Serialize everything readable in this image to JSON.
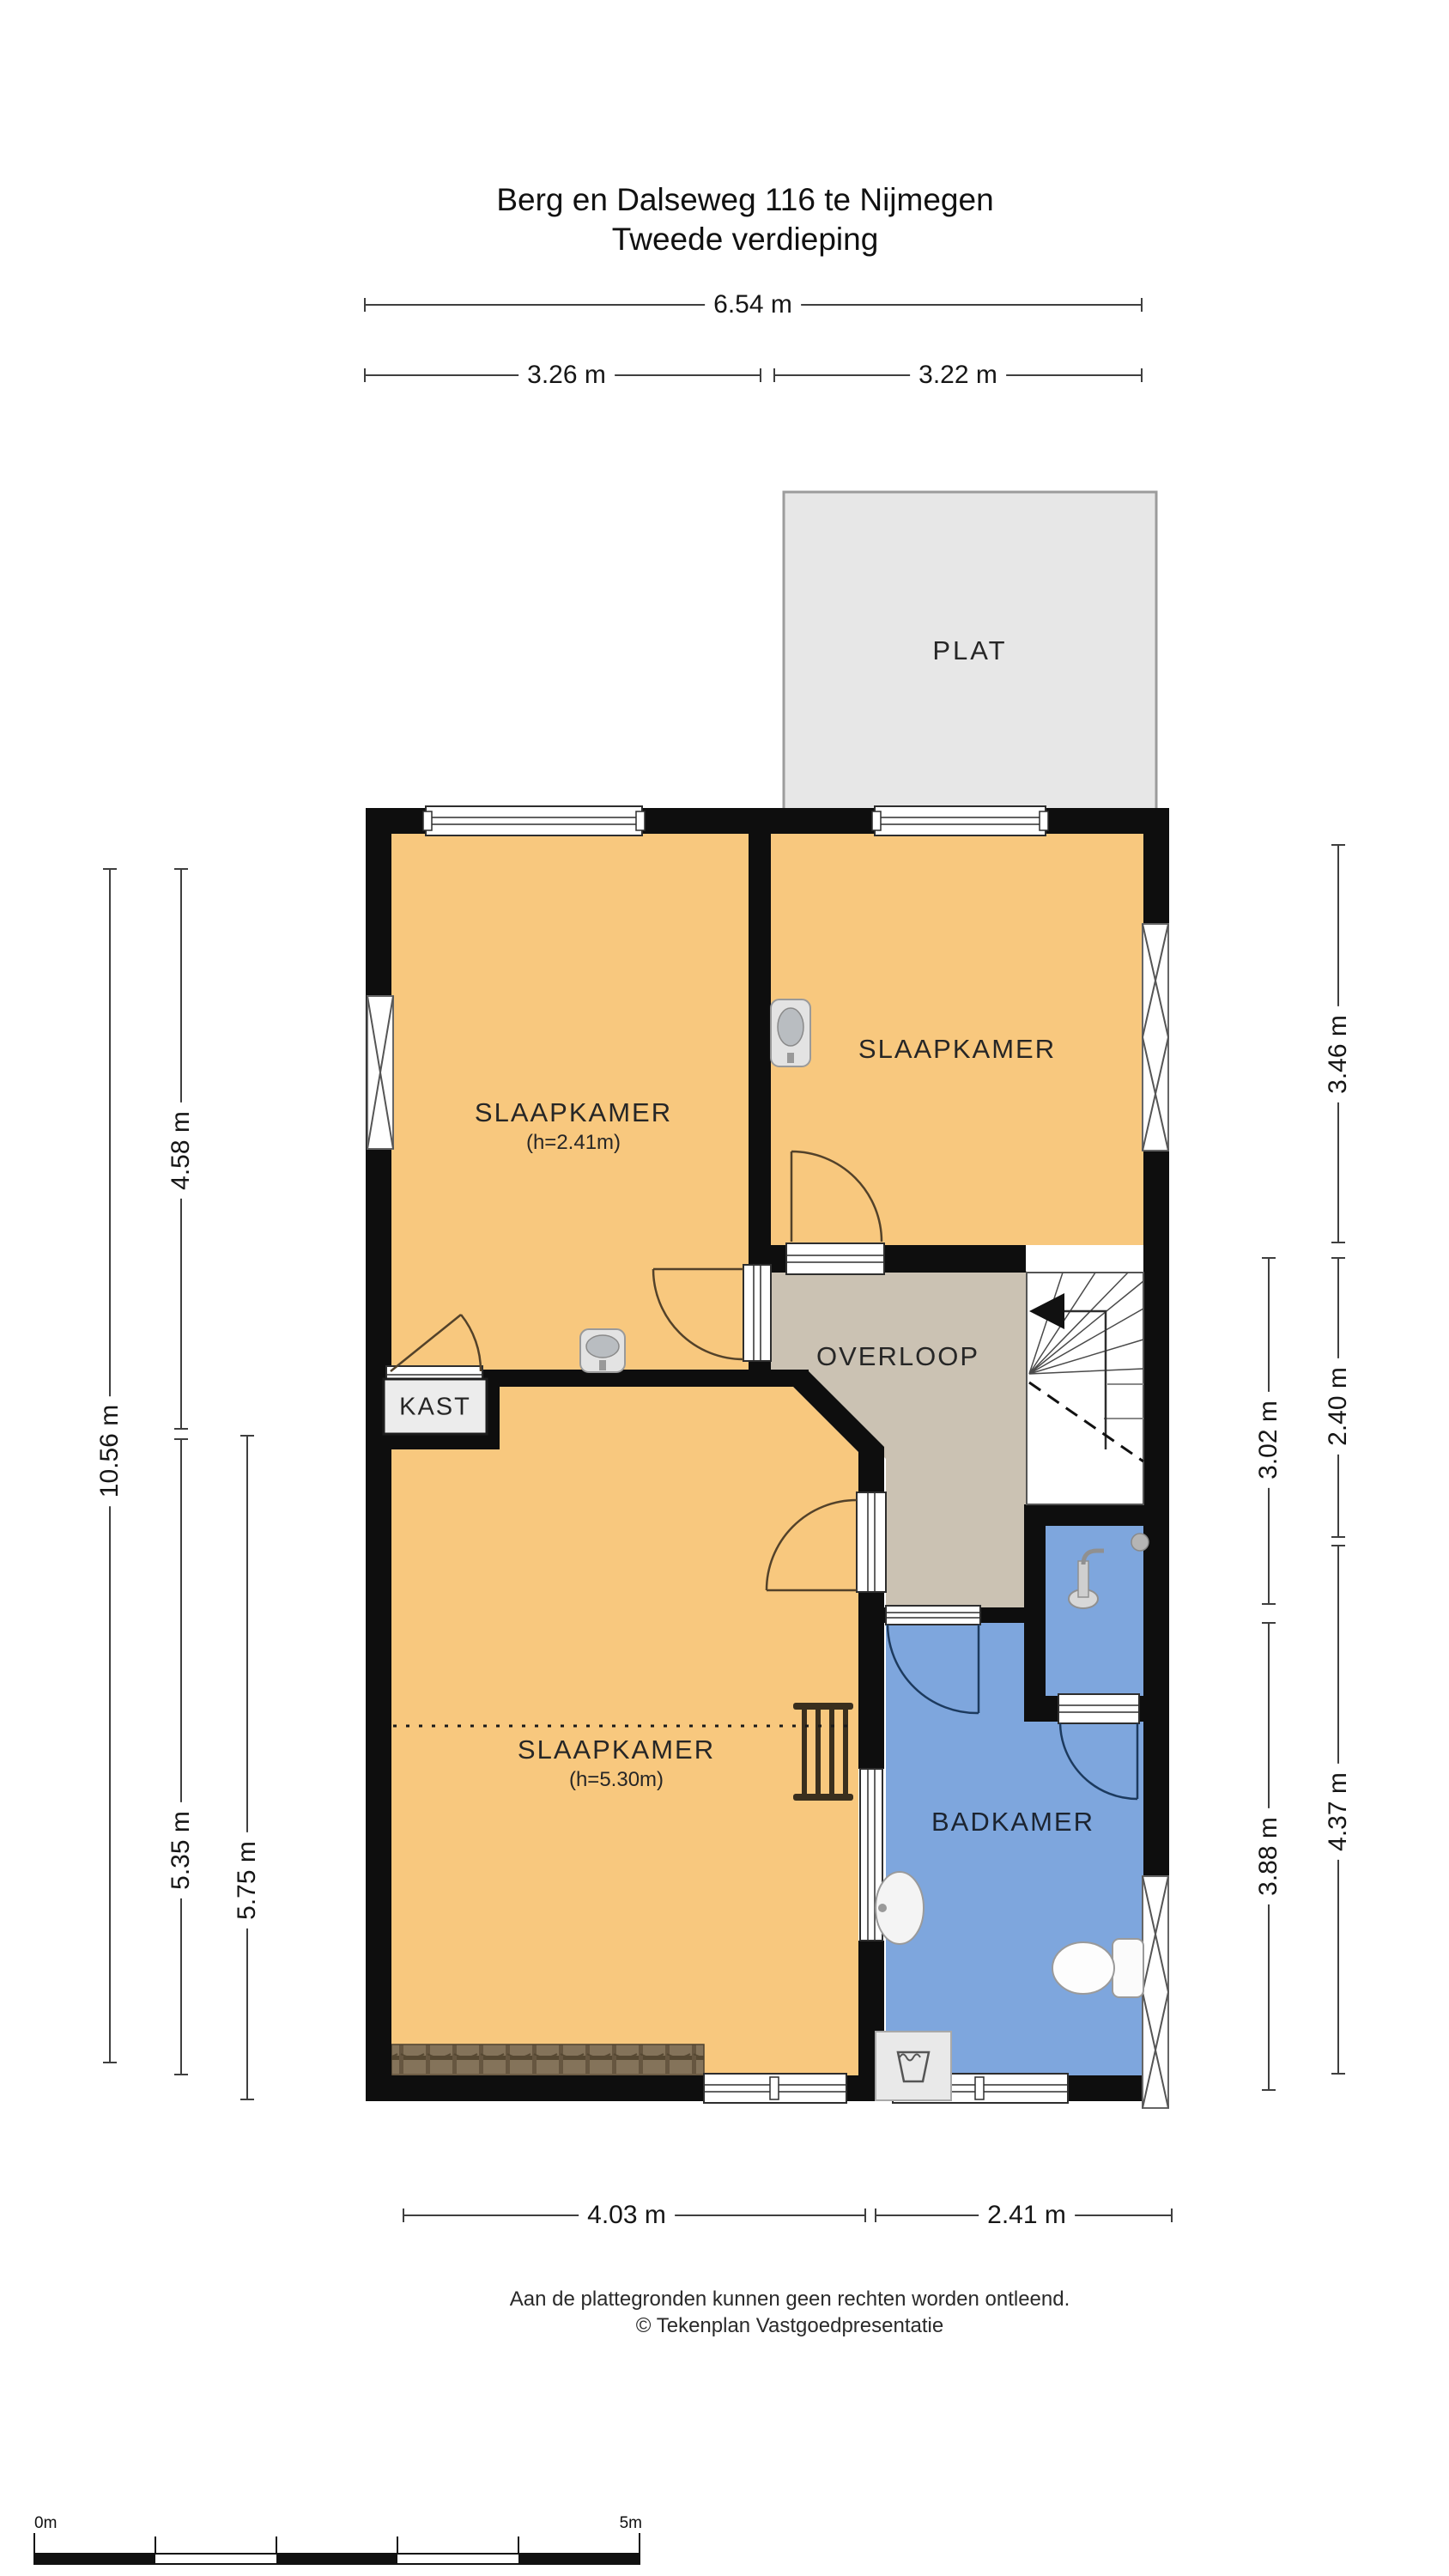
{
  "title": {
    "line1": "Berg en Dalseweg 116 te Nijmegen",
    "line2": "Tweede verdieping"
  },
  "rooms": {
    "plat": {
      "label": "PLAT"
    },
    "slaapkamer_left": {
      "label": "SLAAPKAMER",
      "height_note": "(h=2.41m)"
    },
    "slaapkamer_right": {
      "label": "SLAAPKAMER"
    },
    "overloop": {
      "label": "OVERLOOP"
    },
    "kast": {
      "label": "KAST"
    },
    "slaapkamer_bottom": {
      "label": "SLAAPKAMER",
      "height_note": "(h=5.30m)"
    },
    "badkamer": {
      "label": "BADKAMER"
    }
  },
  "dims": {
    "top_total": "6.54 m",
    "top_left": "3.26 m",
    "top_right": "3.22 m",
    "left_outer": "10.56 m",
    "left_upper": "4.58 m",
    "left_lower": "5.35 m",
    "left_inner": "5.75 m",
    "right_inner_upper": "3.02 m",
    "right_inner_lower": "3.88 m",
    "right_outer_upper": "3.46 m",
    "right_outer_middle": "2.40 m",
    "right_outer_lower": "4.37 m",
    "bottom_left": "4.03 m",
    "bottom_right": "2.41 m"
  },
  "footer": {
    "line1": "Aan de plattegronden kunnen geen rechten worden ontleend.",
    "line2": "© Tekenplan Vastgoedpresentatie"
  },
  "scale_bar": {
    "start_label": "0m",
    "end_label": "5m"
  },
  "colors": {
    "wall": "#0e0e0e",
    "bedroom_fill": "#f8c87e",
    "landing_fill": "#cbc2b3",
    "bathroom_fill": "#7ea6dd",
    "plat_fill": "#e7e7e7",
    "closet_fill": "#ececec",
    "roof_tiles": "#84735a"
  }
}
